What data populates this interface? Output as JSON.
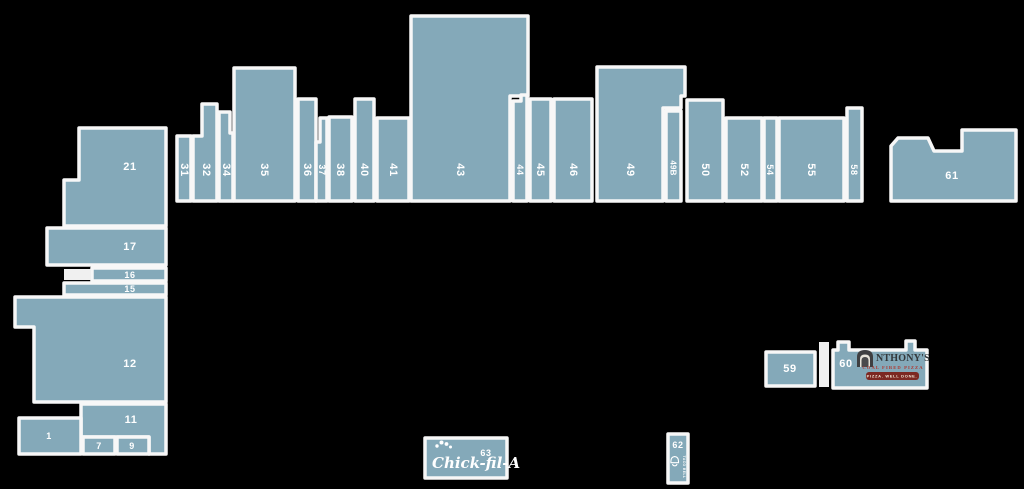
{
  "map": {
    "colors": {
      "background": "#000000",
      "unit_fill": "#84a9b9",
      "unit_stroke": "#f7f7f7",
      "label_color": "#ffffff",
      "anthonys_text": "#33383b",
      "anthonys_red": "#b0372f",
      "anthonys_banner": "#7c2822"
    },
    "units": [
      {
        "id": "21",
        "label": "21",
        "points": "79,128 166,128 166,226 64,226 64,180 79,180",
        "lx": 130,
        "ly": 167,
        "rot": 0,
        "size": ""
      },
      {
        "id": "17",
        "label": "17",
        "points": "47,228 166,228 166,265 47,265",
        "lx": 130,
        "ly": 247,
        "rot": 0,
        "size": ""
      },
      {
        "id": "16",
        "label": "16",
        "points": "92,268 166,268 166,281 92,281",
        "lx": 130,
        "ly": 275,
        "rot": 0,
        "size": "sm"
      },
      {
        "id": "15",
        "label": "15",
        "points": "64,283 166,283 166,295 64,295",
        "lx": 130,
        "ly": 289,
        "rot": 0,
        "size": "sm"
      },
      {
        "id": "12",
        "label": "12",
        "points": "15,297 166,297 166,402 34,402 34,327 15,327",
        "lx": 130,
        "ly": 364,
        "rot": 0,
        "size": ""
      },
      {
        "id": "11",
        "label": "11",
        "points": "81,404 166,404 166,454 149,454 149,437 81,437",
        "lx": 131,
        "ly": 420,
        "rot": 0,
        "size": ""
      },
      {
        "id": "1",
        "label": "1",
        "points": "19,418 81,418 81,454 19,454",
        "lx": 49,
        "ly": 436,
        "rot": 0,
        "size": "sm"
      },
      {
        "id": "7",
        "label": "7",
        "points": "83,437 115,437 115,454 83,454",
        "lx": 99,
        "ly": 446,
        "rot": 0,
        "size": "sm"
      },
      {
        "id": "9",
        "label": "9",
        "points": "117,437 149,437 149,454 117,454",
        "lx": 132,
        "ly": 446,
        "rot": 0,
        "size": "sm"
      },
      {
        "id": "31",
        "label": "31",
        "points": "177,136 191,136 191,201 177,201",
        "lx": 184,
        "ly": 170,
        "rot": 90,
        "size": ""
      },
      {
        "id": "32",
        "label": "32",
        "points": "193,136 202,136 202,104 217,104 217,201 193,201",
        "lx": 206,
        "ly": 170,
        "rot": 90,
        "size": ""
      },
      {
        "id": "34",
        "label": "34",
        "points": "219,112 230,112 230,133 233,133 233,201 219,201",
        "lx": 226,
        "ly": 170,
        "rot": 90,
        "size": ""
      },
      {
        "id": "35",
        "label": "35",
        "points": "234,68 295,68 295,201 234,201",
        "lx": 264,
        "ly": 170,
        "rot": 90,
        "size": ""
      },
      {
        "id": "36",
        "label": "36",
        "points": "298,99 316,99 316,201 298,201",
        "lx": 307,
        "ly": 170,
        "rot": 90,
        "size": ""
      },
      {
        "id": "37",
        "label": "37",
        "points": "320,118 327,118 327,201 316,201 316,142 320,142",
        "lx": 322,
        "ly": 170,
        "rot": 90,
        "size": "sm"
      },
      {
        "id": "38",
        "label": "38",
        "points": "329,117 352,117 352,201 329,201",
        "lx": 340,
        "ly": 170,
        "rot": 90,
        "size": ""
      },
      {
        "id": "40",
        "label": "40",
        "points": "355,99 374,99 374,201 355,201",
        "lx": 364,
        "ly": 170,
        "rot": 90,
        "size": ""
      },
      {
        "id": "41",
        "label": "41",
        "points": "377,118 409,118 409,201 377,201",
        "lx": 393,
        "ly": 170,
        "rot": 90,
        "size": ""
      },
      {
        "id": "43",
        "label": "43",
        "points": "411,16 528,16 528,96 510,96 510,201 411,201",
        "lx": 460,
        "ly": 170,
        "rot": 90,
        "size": ""
      },
      {
        "id": "44",
        "label": "44",
        "points": "513,101 521,101 521,95 527,95 527,201 513,201",
        "lx": 520,
        "ly": 170,
        "rot": 90,
        "size": "sm"
      },
      {
        "id": "45",
        "label": "45",
        "points": "530,99 551,99 551,201 530,201",
        "lx": 540,
        "ly": 170,
        "rot": 90,
        "size": ""
      },
      {
        "id": "46",
        "label": "46",
        "points": "554,99 592,99 592,201 554,201",
        "lx": 573,
        "ly": 170,
        "rot": 90,
        "size": ""
      },
      {
        "id": "49",
        "label": "49",
        "points": "597,67 685,67 685,96 681,96 681,108 663,108 663,201 597,201",
        "lx": 630,
        "ly": 170,
        "rot": 90,
        "size": ""
      },
      {
        "id": "49B",
        "label": "49B",
        "points": "666,111 681,111 681,201 666,201",
        "lx": 673,
        "ly": 168,
        "rot": 90,
        "size": "xs"
      },
      {
        "id": "50",
        "label": "50",
        "points": "687,100 723,100 723,201 687,201",
        "lx": 705,
        "ly": 170,
        "rot": 90,
        "size": ""
      },
      {
        "id": "52",
        "label": "52",
        "points": "726,118 762,118 762,201 726,201",
        "lx": 744,
        "ly": 170,
        "rot": 90,
        "size": ""
      },
      {
        "id": "54",
        "label": "54",
        "points": "764,118 777,118 777,201 764,201",
        "lx": 770,
        "ly": 170,
        "rot": 90,
        "size": "sm"
      },
      {
        "id": "55",
        "label": "55",
        "points": "779,118 844,118 844,201 779,201",
        "lx": 811,
        "ly": 170,
        "rot": 90,
        "size": ""
      },
      {
        "id": "58",
        "label": "58",
        "points": "847,108 862,108 862,201 847,201",
        "lx": 854,
        "ly": 170,
        "rot": 90,
        "size": "sm"
      },
      {
        "id": "61",
        "label": "61",
        "points": "891,146 898,138 928,138 934,151 962,151 962,130 1016,130 1016,201 891,201",
        "lx": 952,
        "ly": 176,
        "rot": 0,
        "size": ""
      },
      {
        "id": "59",
        "label": "59",
        "points": "766,352 815,352 815,386 766,386",
        "lx": 790,
        "ly": 369,
        "rot": 0,
        "size": ""
      },
      {
        "id": "60",
        "label": "60",
        "points": "833,350 838,350 838,342 849,342 849,350 906,350 906,341 915,341 915,350 927,350 927,388 833,388",
        "lx": 846,
        "ly": 364,
        "rot": 0,
        "size": ""
      },
      {
        "id": "62",
        "label": "62",
        "points": "668,434 688,434 688,483 668,483",
        "lx": 678,
        "ly": 445,
        "rot": 0,
        "size": "sm"
      },
      {
        "id": "63",
        "label": "63",
        "points": "425,438 507,438 507,478 425,478",
        "lx": 486,
        "ly": 453,
        "rot": 0,
        "size": "sm"
      }
    ],
    "decor": [
      {
        "name": "unit-59-60-connector",
        "points": "819,342 829,342 829,387 819,387",
        "fill": "#f0f0f0"
      },
      {
        "name": "unit-16-side-block",
        "points": "64,269 91,269 91,280 64,280",
        "fill": "#f0f0f0"
      }
    ],
    "logos": [
      {
        "unit": "63",
        "name": "chickfila-logo",
        "items": [
          {
            "type": "icon",
            "ref": "comb",
            "name": "rooster-comb-icon",
            "x": 434,
            "y": 440
          },
          {
            "type": "text",
            "cls": "cfa-script",
            "text": "Chick-fil-A",
            "x": 432,
            "y": 468
          }
        ]
      },
      {
        "unit": "60",
        "name": "anthonys-logo",
        "items": [
          {
            "type": "icon",
            "ref": "oven",
            "name": "coal-oven-icon",
            "x": 857,
            "y": 350
          },
          {
            "type": "text",
            "cls": "anthonys-name",
            "text": "NTHONY'S",
            "x": 876,
            "y": 361
          },
          {
            "type": "text",
            "cls": "anthonys-sub",
            "text": "COAL FIRED PIZZA",
            "x": 893,
            "y": 369
          },
          {
            "type": "rect",
            "cls": "anthonys-banner",
            "x": 866,
            "y": 372,
            "w": 53,
            "h": 8,
            "rx": 3
          },
          {
            "type": "text",
            "cls": "anthonys-banner-text",
            "text": "PIZZA. WELL DONE.",
            "x": 892,
            "y": 376
          }
        ]
      },
      {
        "unit": "62",
        "name": "tacobell-logo",
        "items": [
          {
            "type": "icon",
            "ref": "bell",
            "name": "bell-icon",
            "x": 670,
            "y": 456
          },
          {
            "type": "text",
            "cls": "tb-text",
            "text": "TACO BELL",
            "x": 684,
            "y": 467,
            "rot": 90
          }
        ]
      }
    ]
  }
}
